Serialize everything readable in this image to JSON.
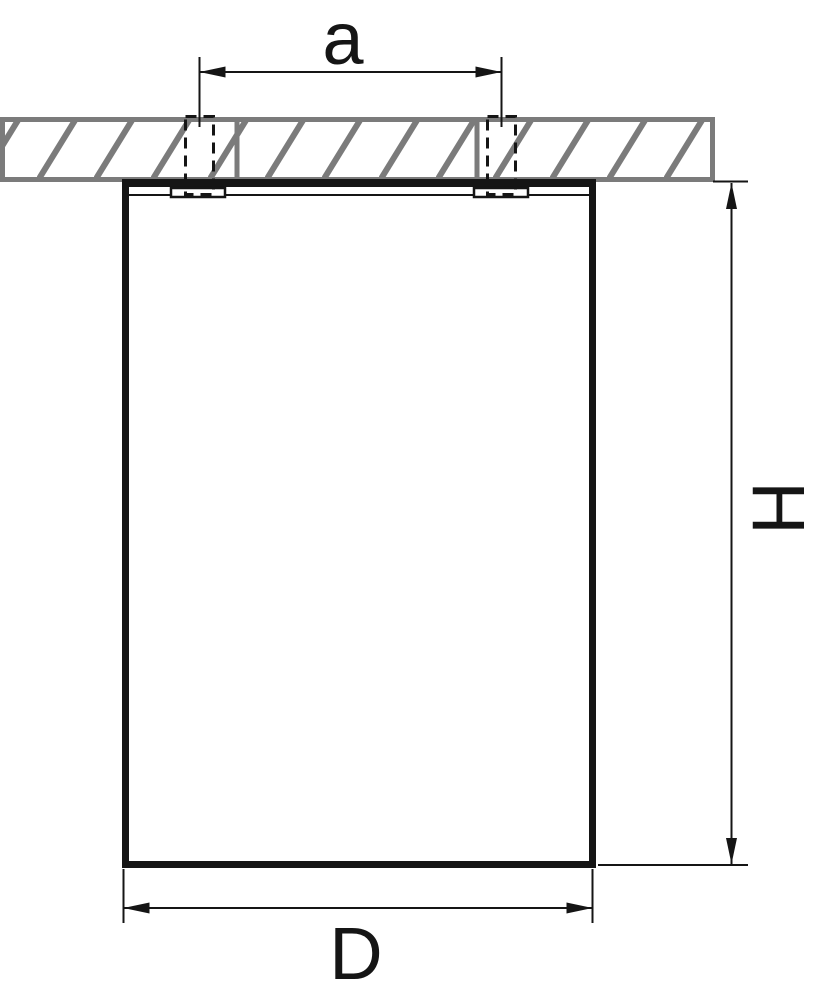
{
  "diagram": {
    "type": "technical-dimension-drawing",
    "subject": "surface-mounted cylindrical ceiling light fixture, side section view with ceiling and mounting screws",
    "labels": {
      "screw_spacing": "a",
      "height": "H",
      "diameter": "D"
    },
    "colors": {
      "line": "#151515",
      "ceiling_gray": "#7b7b7b",
      "background": "#ffffff"
    }
  }
}
